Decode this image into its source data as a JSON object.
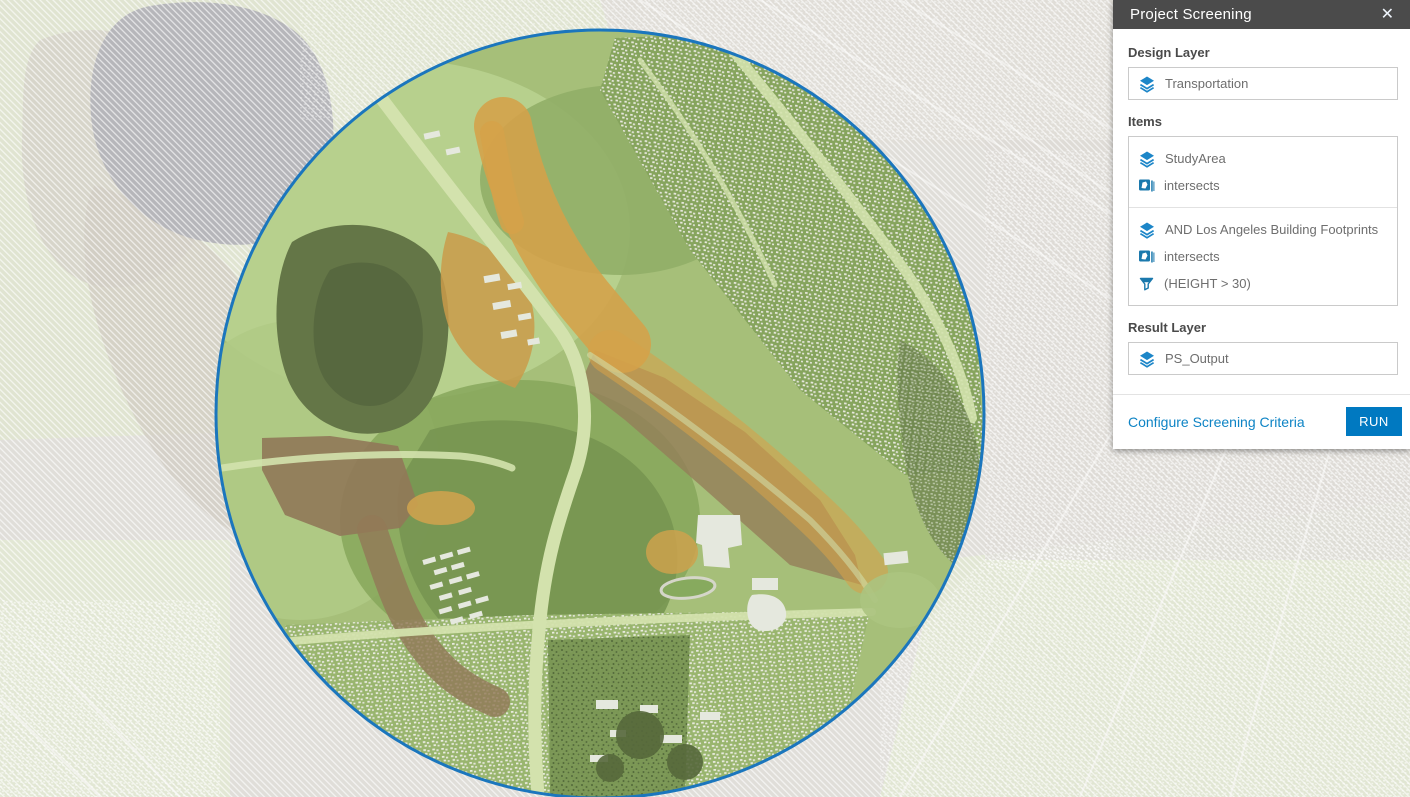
{
  "panel": {
    "title": "Project Screening",
    "icons": {
      "close": "✕"
    },
    "design_layer": {
      "label": "Design Layer",
      "value": "Transportation"
    },
    "items": {
      "label": "Items",
      "groups": [
        {
          "layer": "StudyArea",
          "operation": "intersects"
        },
        {
          "layer": "AND Los Angeles Building Footprints",
          "operation": "intersects",
          "filter": "(HEIGHT > 30)"
        }
      ]
    },
    "result_layer": {
      "label": "Result Layer",
      "value": "PS_Output"
    },
    "footer": {
      "configure_link": "Configure Screening Criteria",
      "run_button": "RUN"
    }
  },
  "map": {
    "study_area_outline_color": "#1b76bd",
    "screening_highlight_color": "#d89a3d",
    "header_bg": "#4b4b4b",
    "accent": "#0079c1"
  }
}
